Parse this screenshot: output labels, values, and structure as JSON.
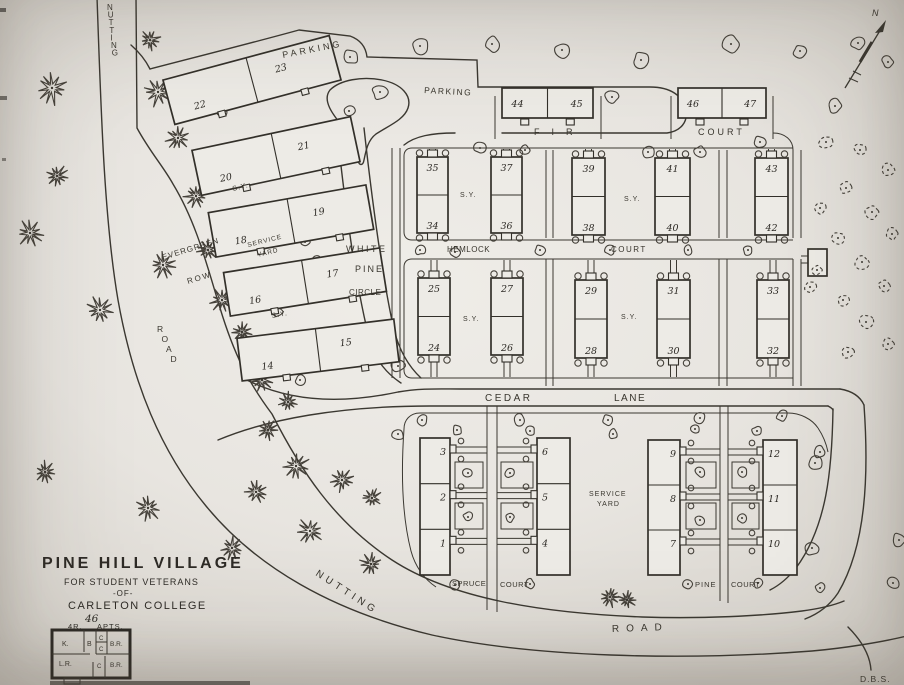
{
  "map": {
    "labels": {
      "nutting_top": "NUTTING",
      "road_left": "ROAD",
      "evergreen": "EVERGREEN",
      "row": "ROW",
      "white": "WHITE",
      "pine": "PINE",
      "circle": "CIRCLE",
      "parking_nw": "PARKING",
      "parking_ne": "PARKING",
      "fir": "FIR",
      "fir_court": "COURT",
      "hemlock": "HEMLOCK",
      "hemlock_court": "COURT",
      "cedar": "CEDAR",
      "lane": "LANE",
      "sy": "S.Y.",
      "service": "SERVICE",
      "yard": "YARD",
      "spruce": "SPRUCE",
      "spruce_court": "COURT",
      "pine_court_name": "PINE",
      "pine_court": "COURT",
      "nutting_bottom": "NUTTING",
      "road_bottom": "ROAD",
      "north": "N",
      "signature": "D.B.S."
    },
    "title_block": {
      "line1": "PINE HILL VILLAGE",
      "line2": "FOR STUDENT VETERANS",
      "line3": "-OF-",
      "line4": "CARLETON COLLEGE"
    },
    "legend": {
      "count": "46",
      "rooms_label": "4R.",
      "apts_label": "APTS.",
      "rooms": {
        "kitchen": "K.",
        "bath": "B",
        "closet_top": "C",
        "closet_mid": "C",
        "bedroom1": "B.R.",
        "living": "L.R.",
        "closet_bottom": "C",
        "bedroom2": "B.R."
      }
    },
    "buildings": {
      "evergreen_row": [
        [
          "22",
          "23"
        ],
        [
          "20",
          "21"
        ],
        [
          "18",
          "19"
        ],
        [
          "16",
          "17"
        ],
        [
          "14",
          "15"
        ]
      ],
      "fir_court": [
        [
          "44",
          "45"
        ],
        [
          "46",
          "47"
        ]
      ],
      "hemlock_court_north": [
        [
          "35",
          "34"
        ],
        [
          "37",
          "36"
        ],
        [
          "39",
          "38"
        ],
        [
          "41",
          "40"
        ],
        [
          "43",
          "42"
        ]
      ],
      "hemlock_court_south": [
        [
          "25",
          "24"
        ],
        [
          "27",
          "26"
        ],
        [
          "29",
          "28"
        ],
        [
          "31",
          "30"
        ],
        [
          "33",
          "32"
        ]
      ],
      "spruce_court": [
        [
          "3",
          "2",
          "1"
        ],
        [
          "6",
          "5",
          "4"
        ]
      ],
      "pine_court": [
        [
          "9",
          "8",
          "7"
        ],
        [
          "12",
          "11",
          "10"
        ]
      ]
    }
  }
}
